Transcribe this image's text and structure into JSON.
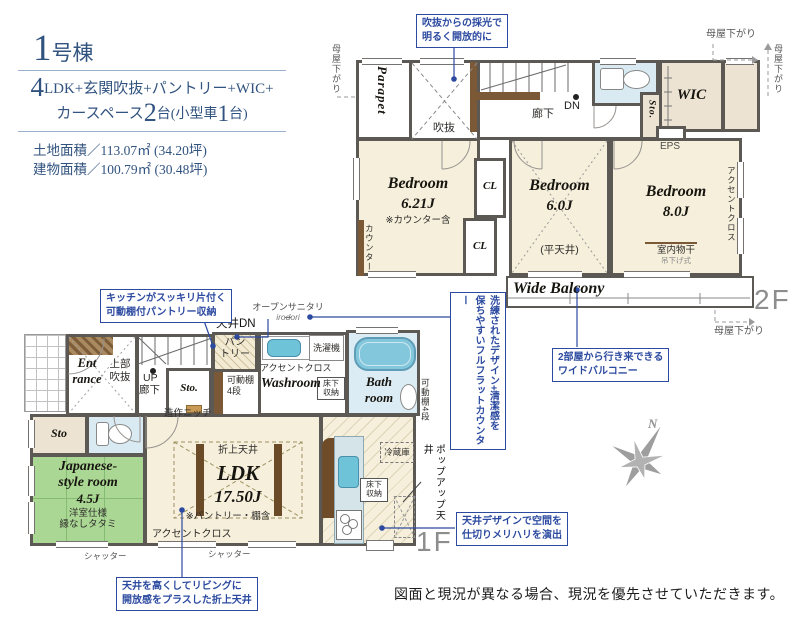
{
  "title_block": {
    "unit_number": "1",
    "unit_suffix": "号棟",
    "spec_num1": "4",
    "spec_text1": "LDK+玄関吹抜+パントリー+WIC+",
    "spec_text2a": "カースペース",
    "spec_num2": "2",
    "spec_text2b": "台(小型車",
    "spec_num3": "1",
    "spec_text2c": "台)",
    "land_area": "土地面積／113.07㎡ (34.20坪)",
    "building_area": "建物面積／100.79㎡ (30.48坪)"
  },
  "callouts": {
    "daylight": "吹抜からの採光で\n明るく開放的に",
    "balcony": "2部屋から行き来できる\nワイドバルコニー",
    "pantry": "キッチンがスッキリ片付く\n可動棚付パントリー収納",
    "flat_counter": "洗練されたデザイン+清潔感を\n保ちやすいフルフラットカウンター",
    "ceiling_zoning": "天井デザインで空間を\n仕切りメリハリを演出",
    "coffered_ceiling": "天井を高くしてリビングに\n開放感をプラスした折上天井"
  },
  "floor2": {
    "floor_label": "2F",
    "moyasagari": "母屋下がり",
    "parapet": "Parapet",
    "void": "吹抜",
    "hall": "廊下",
    "dn": "DN",
    "sto": "Sto.",
    "wic": "WIC",
    "eps": "EPS",
    "bedroom1_name": "Bedroom",
    "bedroom1_size": "6.21J",
    "bedroom1_note": "※カウンター含",
    "counter": "カウンター",
    "cl": "CL",
    "bedroom2_name": "Bedroom",
    "bedroom2_size": "6.0J",
    "flat_ceiling": "(平天井)",
    "bedroom3_name": "Bedroom",
    "bedroom3_size": "8.0J",
    "indoor_drying": "室内物干",
    "hanging_type": "吊下げ式",
    "accent_cloth": "アクセントクロス",
    "balcony": "Wide Balcony"
  },
  "floor1": {
    "floor_label": "1F",
    "entrance": "Ent\nrance",
    "upper_void": "上部\n吹抜",
    "up": "UP",
    "hall": "廊下",
    "sto": "Sto.",
    "sto2": "Sto",
    "ceiling_dn": "天井DN",
    "pantry": "パン\nトリー",
    "movable_shelf": "可動棚\n4段",
    "movable_shelf_v": "可動棚4段",
    "niche": "造作ニッチ",
    "open_sanitary": "オープンサニタリー",
    "open_sanitary_brand": "irodori",
    "accent_cloth": "アクセントクロス",
    "washroom": "Washroom",
    "washer": "洗濯機",
    "underfloor_storage": "床下\n収納",
    "bathroom": "Bath\nroom",
    "jroom_name": "Japanese-\nstyle room",
    "jroom_size": "4.5J",
    "jroom_note": "洋室仕様\n縁なしタタミ",
    "ldk_name": "LDK",
    "ldk_size": "17.50J",
    "coffered": "折上天井",
    "ldk_note": "※パントリー・棚含",
    "fridge": "冷蔵庫",
    "popup_ceiling": "ポップアップ天井",
    "shutter": "シャッター"
  },
  "compass_n": "N",
  "disclaimer": "図面と現況が異なる場合、現況を優先させていただきます。"
}
